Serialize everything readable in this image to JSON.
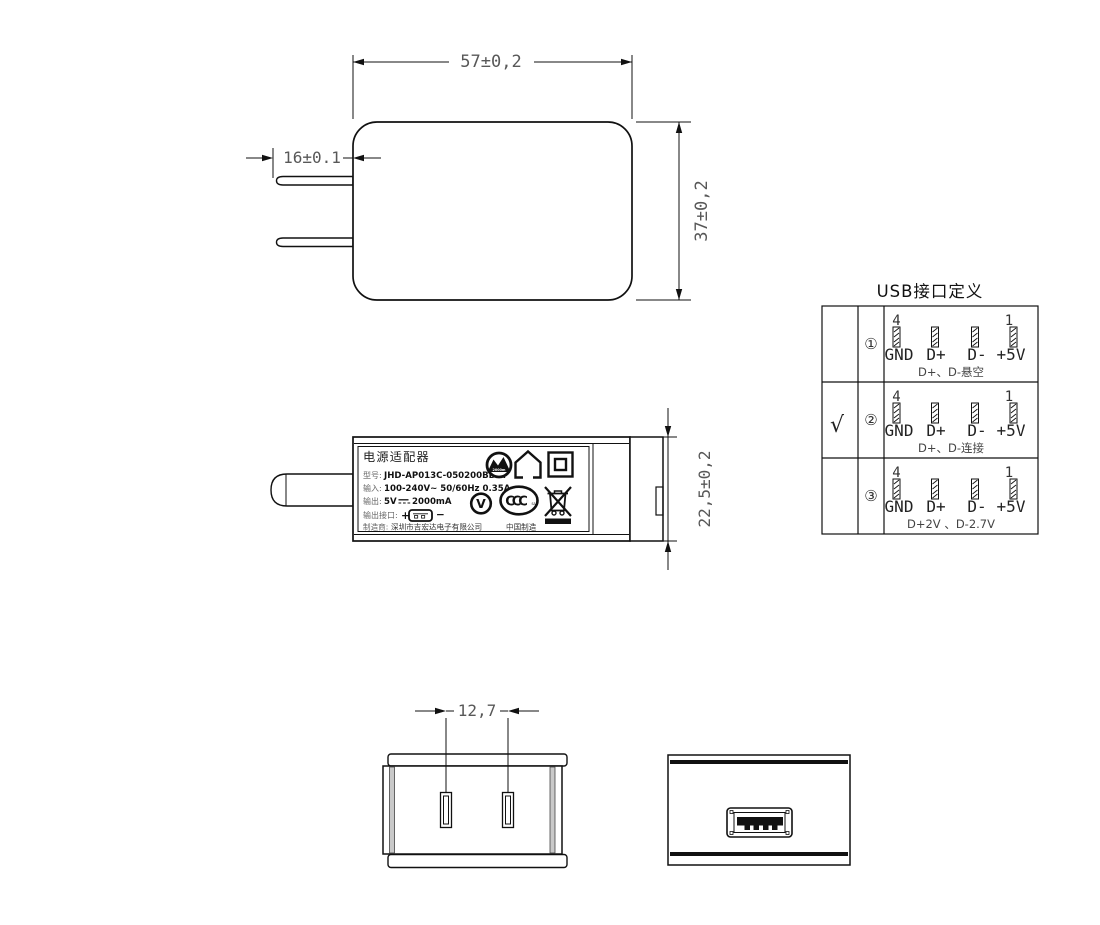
{
  "drawing": {
    "front_view": {
      "dim_width": "57±0,2",
      "dim_height": "37±0,2",
      "dim_prong_length": "16±0.1"
    },
    "side_view": {
      "dim_thickness": "22,5±0,2",
      "label": {
        "title": "电源适配器",
        "model_key": "型号:",
        "model_value": "JHD-AP013C-050200BB-A",
        "input_key": "输入:",
        "input_value": "100-240V~  50/60Hz  0.35A",
        "output_key": "输出:",
        "output_voltage": "5V",
        "output_current": "2000mA",
        "port_key": "输出接口:",
        "port_plus": "+",
        "port_minus": "−",
        "maker_key": "制造商:",
        "maker_value": "深圳市吉宏达电子有限公司",
        "made_in": "中国制造",
        "altitude_text": "2000m",
        "efficiency_letter": "V",
        "ccc_letters": "CCC",
        "ccc_sub": "S&E",
        "icons": [
          "altitude-2000m",
          "indoor-use-only",
          "class-ii",
          "efficiency-v",
          "ccc-mark",
          "weee-bin"
        ]
      }
    },
    "back_view": {
      "dim_pin_pitch": "12,7"
    },
    "usb_face_view": {}
  },
  "usb_table": {
    "title": "USB接口定义",
    "pin_number_left": "4",
    "pin_number_right": "1",
    "pin_labels": [
      "GND",
      "D+",
      "D-",
      "+5V"
    ],
    "rows": [
      {
        "selected": "",
        "index": "①",
        "note": "D+、D-悬空"
      },
      {
        "selected": "√",
        "index": "②",
        "note": "D+、D-连接"
      },
      {
        "selected": "",
        "index": "③",
        "note": "D+2V 、D-2.7V"
      }
    ]
  }
}
